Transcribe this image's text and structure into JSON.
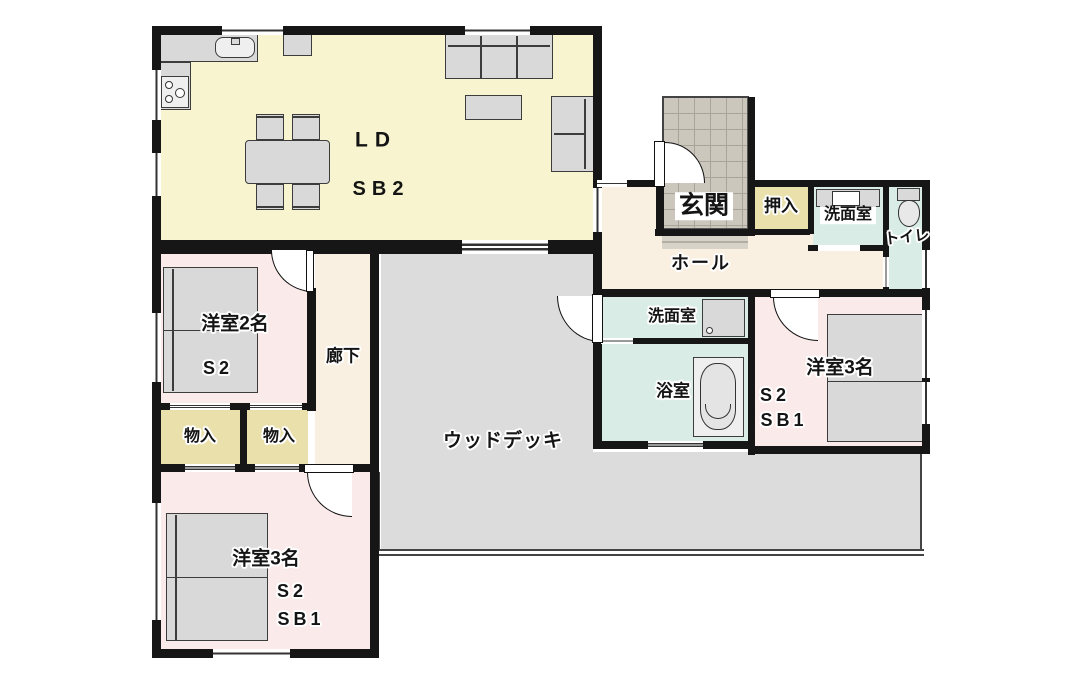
{
  "palette": {
    "ld": "#f8f4cf",
    "bedroom": "#faeae9",
    "hall": "#faf0e2",
    "closet": "#e9e0ac",
    "wet": "#d9ece5",
    "deck": "#dcdcdd",
    "tileLight": "#d7d3c9",
    "wall": "#161616"
  },
  "labels": {
    "ld": "LD",
    "ld_sub": "SB2",
    "genkan": "玄関",
    "oshiire": "押入",
    "senmenshitsu_top": "洗面室",
    "toilet": "トイレ",
    "hall": "ホール",
    "senmenshitsu_mid": "洗面室",
    "bath": "浴室",
    "wood_deck": "ウッドデッキ",
    "rouka": "廊下",
    "monoire_left": "物入",
    "monoire_right": "物入",
    "yoshitsu2_label": "洋室2名",
    "yoshitsu2_s": "S2",
    "yoshitsu3_right_label": "洋室3名",
    "yoshitsu3_right_s": "S2",
    "yoshitsu3_right_sb": "SB1",
    "yoshitsu3_bottom_label": "洋室3名",
    "yoshitsu3_bottom_s": "S2",
    "yoshitsu3_bottom_sb": "SB1"
  }
}
